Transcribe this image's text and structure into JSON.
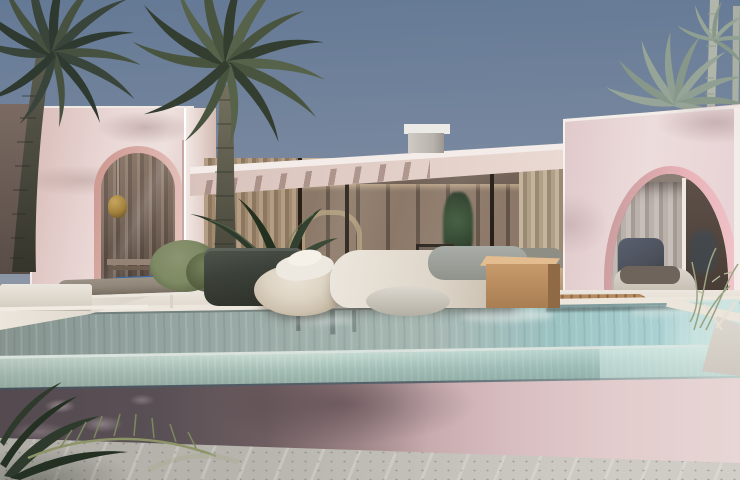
{
  "scene": {
    "type": "architectural-render",
    "subject": "pink-villa-with-infinity-pool",
    "time_of_day": "day",
    "objects": [
      "sky",
      "palm-trees",
      "left-wing-wall",
      "left-arch-window",
      "pendant-lamp",
      "central-glass-pavilion",
      "flat-roof",
      "roof-chimney",
      "dining-table",
      "dining-chairs",
      "sofa",
      "arc-floor-lamp",
      "right-wing-wall",
      "right-arch-window",
      "lounge-chair",
      "infinity-pool",
      "glass-pool-wall",
      "pool-deck",
      "wooden-deck",
      "sun-lounger",
      "blue-pool-towel",
      "cream-ottoman",
      "white-daybed",
      "wooden-side-table",
      "potted-plant",
      "green-shrub",
      "concrete-ground",
      "foreground-palm-fronds"
    ]
  },
  "palette": {
    "sky_top": "#647995",
    "sky_mid": "#7d8ba1",
    "sky_low": "#9aa1ac",
    "sky_horizon": "#aaadb3",
    "wall_pink": "#e9d7d5",
    "wall_pink_shade": "#dcc1bd",
    "wall_pink_deep": "#c9a59f",
    "trim_white": "#f3ece8",
    "arch_rim": "#cc968e",
    "arch_rim_pink": "#e9b4ba",
    "interior_warm": "#7b6a5e",
    "interior_dark": "#4e4138",
    "curtain_tan": "#b39d84",
    "curtain_gray": "#c6beb9",
    "gold": "#a3813d",
    "roof_fascia": "#e3d0c9",
    "chimney_gray": "#b8b3ac",
    "deck_white": "#ece6de",
    "wood": "#b68a5f",
    "wood_dark": "#8a6544",
    "water_gray": "#93a4a0",
    "water_teal": "#a9cfd0",
    "water_light": "#cde4e0",
    "glass_light": "#c6dbd2",
    "glass_mid": "#a3bdb4",
    "pool_lip": "#46525b",
    "pool_wall_dark": "#595055",
    "pool_wall_pink": "#e2cbcc",
    "ground": "#b8b5af",
    "ground_light": "#ccc8c2",
    "palm_dark": "#39443a",
    "palm_mid": "#49543f",
    "palm_pale": "#96a597",
    "trunk_pale": "#b0b6a9",
    "plant_dark": "#2d3a2c",
    "pot": "#3c413a",
    "shrub": "#7e8a64",
    "blue_mat": "#3e6ba3",
    "pouf_cream": "#ddd4c4",
    "cushion_gray": "#a9ada7",
    "lounger_taupe": "#90877a",
    "sofa_beige": "#c9ae8a",
    "chair_white": "#d7d0c3",
    "chair_cushion_dark": "#4b505a"
  }
}
